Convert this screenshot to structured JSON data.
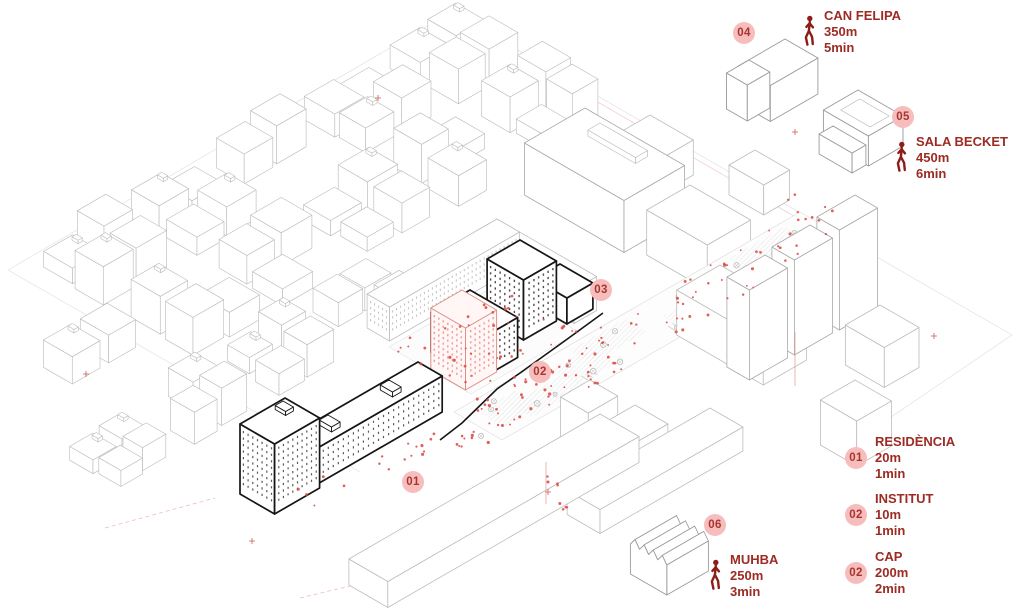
{
  "diagram": {
    "type": "axonometric-site-map",
    "markers": {
      "m01": "01",
      "m02": "02",
      "m03": "03",
      "m04": "04",
      "m05": "05",
      "m06": "06"
    },
    "poi": [
      {
        "ref": "04",
        "name": "CAN FELIPA",
        "distance": "350m",
        "walk_time": "5min"
      },
      {
        "ref": "05",
        "name": "SALA BECKET",
        "distance": "450m",
        "walk_time": "6min"
      },
      {
        "ref": "06",
        "name": "MUHBA",
        "distance": "250m",
        "walk_time": "3min"
      }
    ],
    "legend": [
      {
        "ref": "01",
        "name": "RESIDÈNCIA",
        "distance": "20m",
        "walk_time": "1min"
      },
      {
        "ref": "02",
        "name": "INSTITUT",
        "distance": "10m",
        "walk_time": "1min"
      },
      {
        "ref": "02",
        "name": "CAP",
        "distance": "200m",
        "walk_time": "2min"
      }
    ]
  },
  "colors": {
    "accent_text": "#9c2b23",
    "icon_red": "#8c1d18",
    "marker_fill": "#f7bcbc",
    "marker_text": "#a83530",
    "dot_red": "#dc4a42",
    "line_gray": "#bdbdbd",
    "line_dark": "#161616",
    "highlight_pink": "#dd9089",
    "background": "#ffffff"
  },
  "icons": {
    "walking_person": "walking-person"
  }
}
